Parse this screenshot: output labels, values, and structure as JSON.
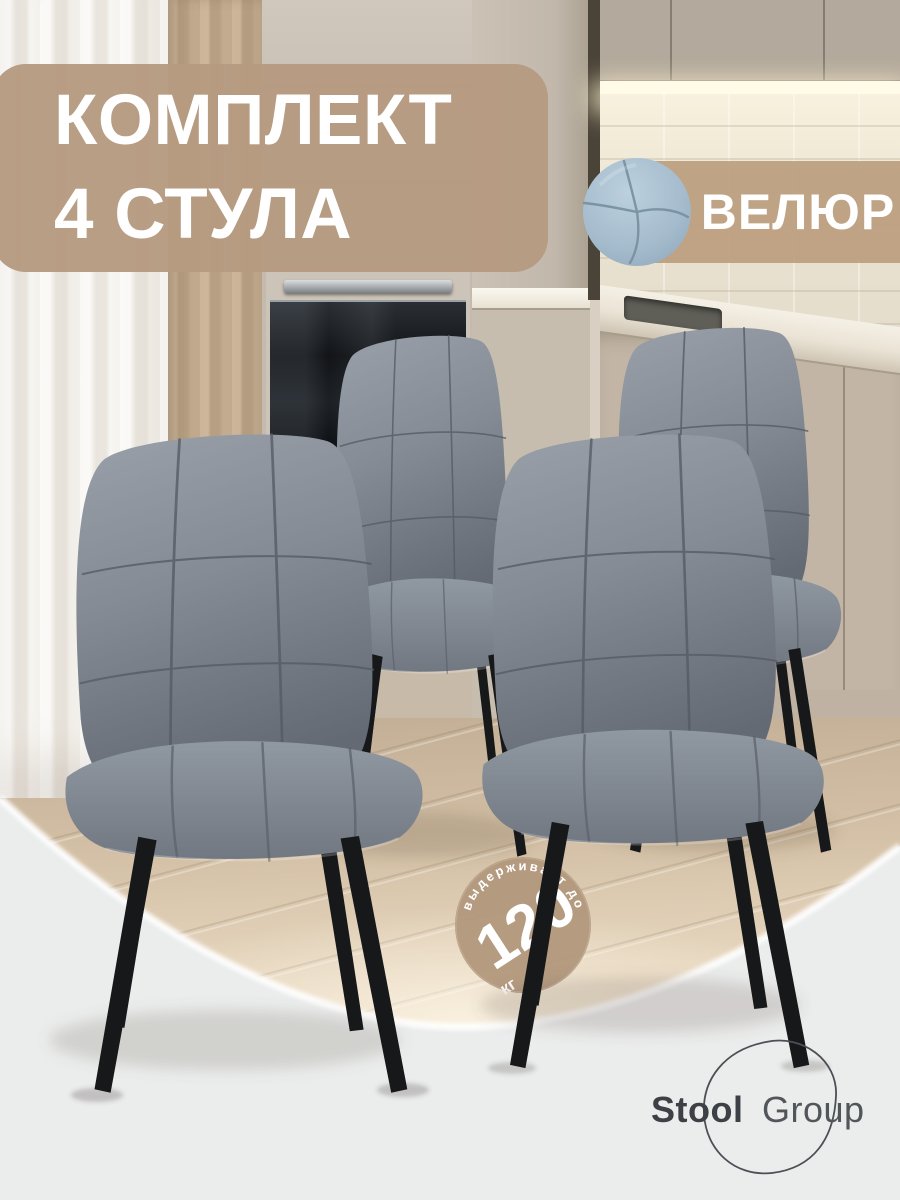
{
  "header_badge": {
    "line1": "КОМПЛЕКТ",
    "line2": "4 СТУЛА"
  },
  "material_badge": {
    "label": "ВЕЛЮР"
  },
  "capacity_badge": {
    "arc_text": "выдерживает до",
    "value": "120",
    "unit": "кг"
  },
  "brand": {
    "bold": "Stool",
    "light": "Group"
  },
  "scene": {
    "chair_count": 4
  },
  "colors": {
    "badge_tan": "#b69b80",
    "capacity_tan": "#b1977b",
    "chair_fabric": "#858c95",
    "chair_legs": "#17181a",
    "swatch_blue": "#a9c0d2",
    "bottom_background": "#ebecec",
    "led_glow": "#fffbe8",
    "logo_text": "#3d4145"
  }
}
